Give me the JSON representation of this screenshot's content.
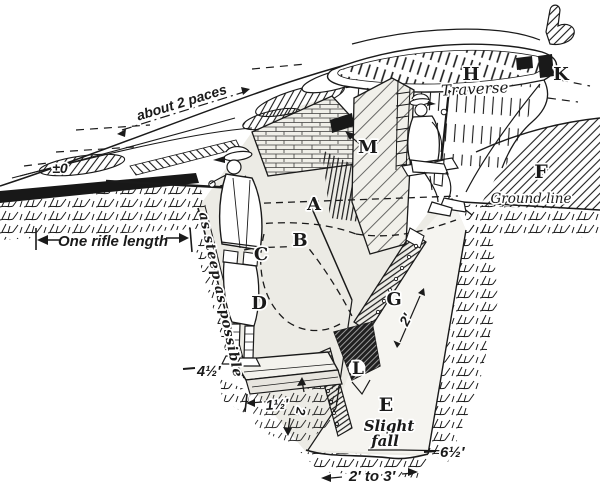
{
  "palette": {
    "ink": "#1a1a1a",
    "paper": "#ffffff"
  },
  "diagram": {
    "part_labels": {
      "a": "A",
      "b": "B",
      "c": "C",
      "d": "D",
      "e": "E",
      "f": "F",
      "g": "G",
      "h": "H",
      "k": "K",
      "l": "L",
      "m": "M"
    },
    "annotations": {
      "about_2_paces": "about 2 paces",
      "datum": "±0",
      "one_rifle_length": "One rifle length",
      "as_steep_as_possible": "as steep as possible",
      "traverse": "Traverse",
      "ground_line": "Ground line",
      "slight_fall_line1": "Slight",
      "slight_fall_line2": "fall"
    },
    "measurements": {
      "parapet_to_firestep": "4½′",
      "firestep_width": "1½′",
      "firestep_height": "2",
      "drain_board_length": "2′",
      "trench_depth": "6½′",
      "floor_width": "2′ to 3′"
    }
  }
}
